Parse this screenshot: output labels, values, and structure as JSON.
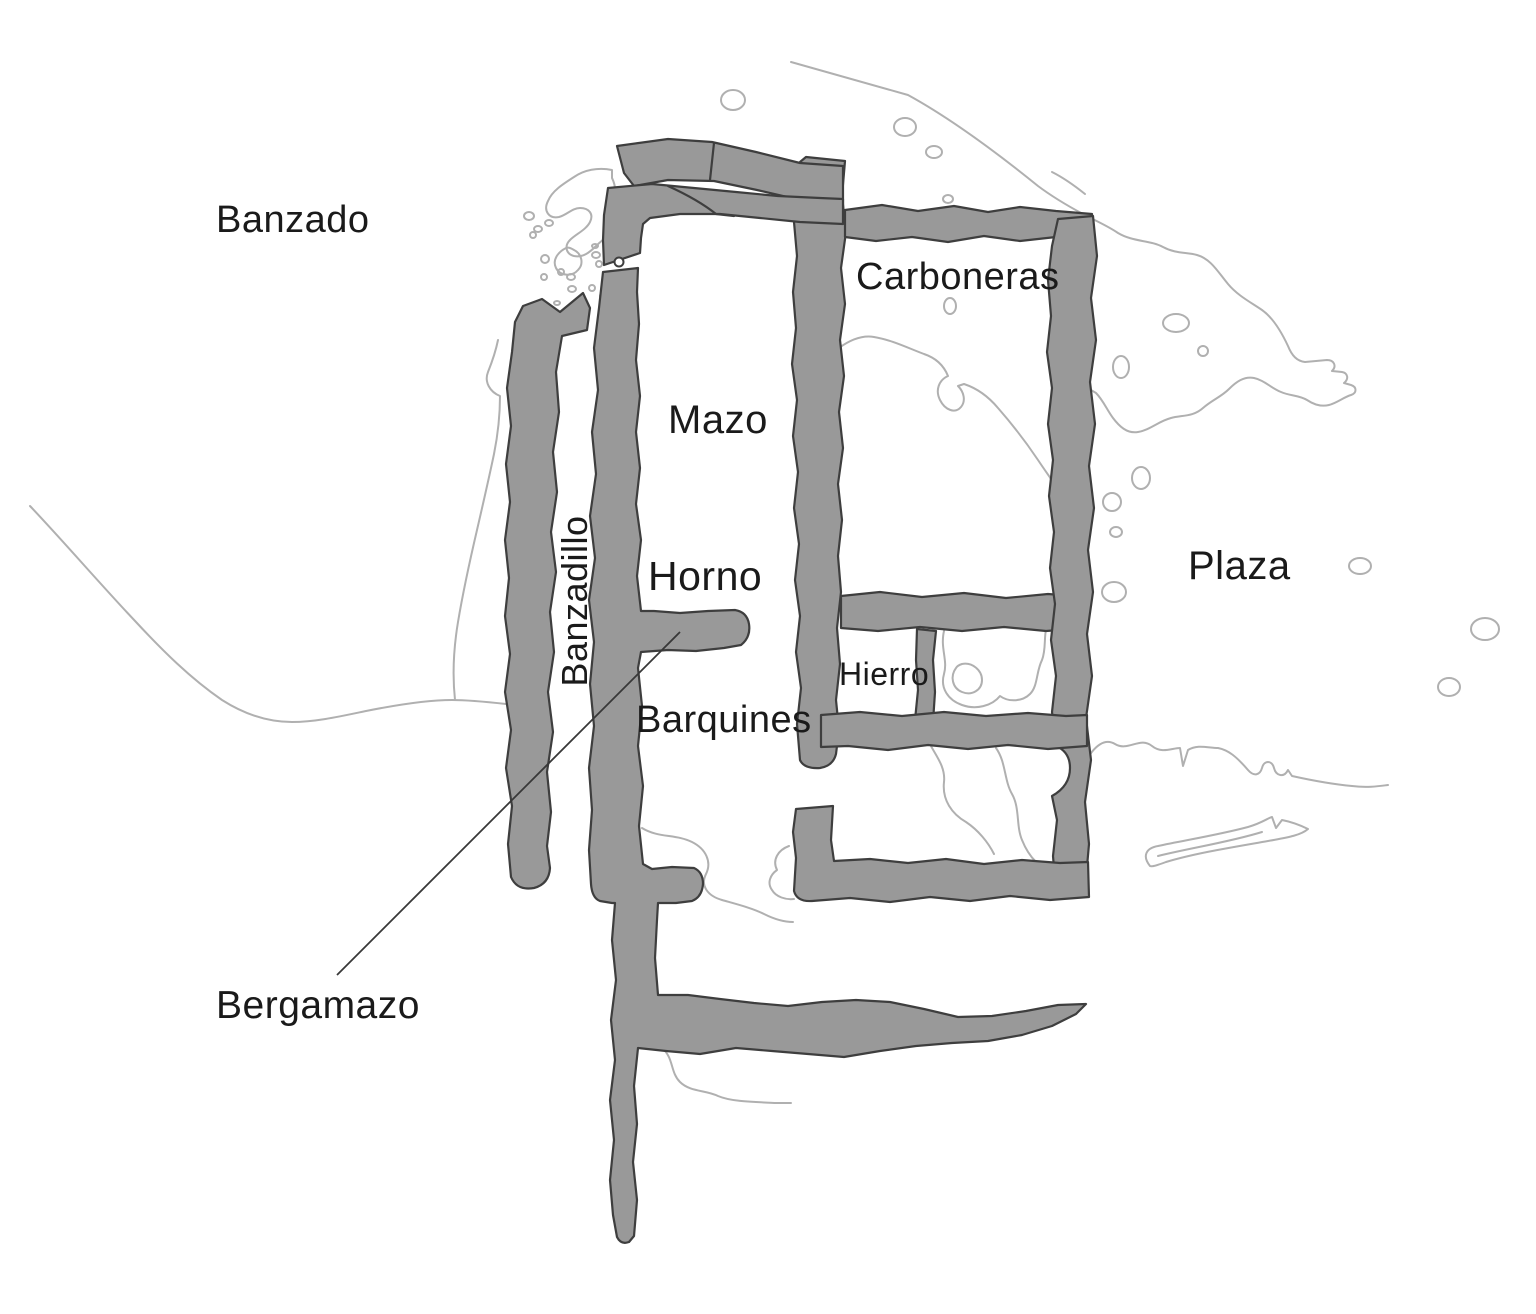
{
  "diagram": {
    "kind": "archaeological-site-plan",
    "labels": {
      "banzado": "Banzado",
      "carboneras": "Carboneras",
      "mazo": "Mazo",
      "banzadillo": "Banzadillo",
      "horno": "Horno",
      "hierro": "Hierro",
      "barquines": "Barquines",
      "plaza": "Plaza",
      "bergamazo": "Bergamazo"
    },
    "colors": {
      "background": "#ffffff",
      "wall_fill": "#999999",
      "wall_outline": "#3e3e3e",
      "contour_line": "#b0b0b0",
      "pointer_line": "#383838",
      "label_text": "#1a1a1a"
    }
  }
}
